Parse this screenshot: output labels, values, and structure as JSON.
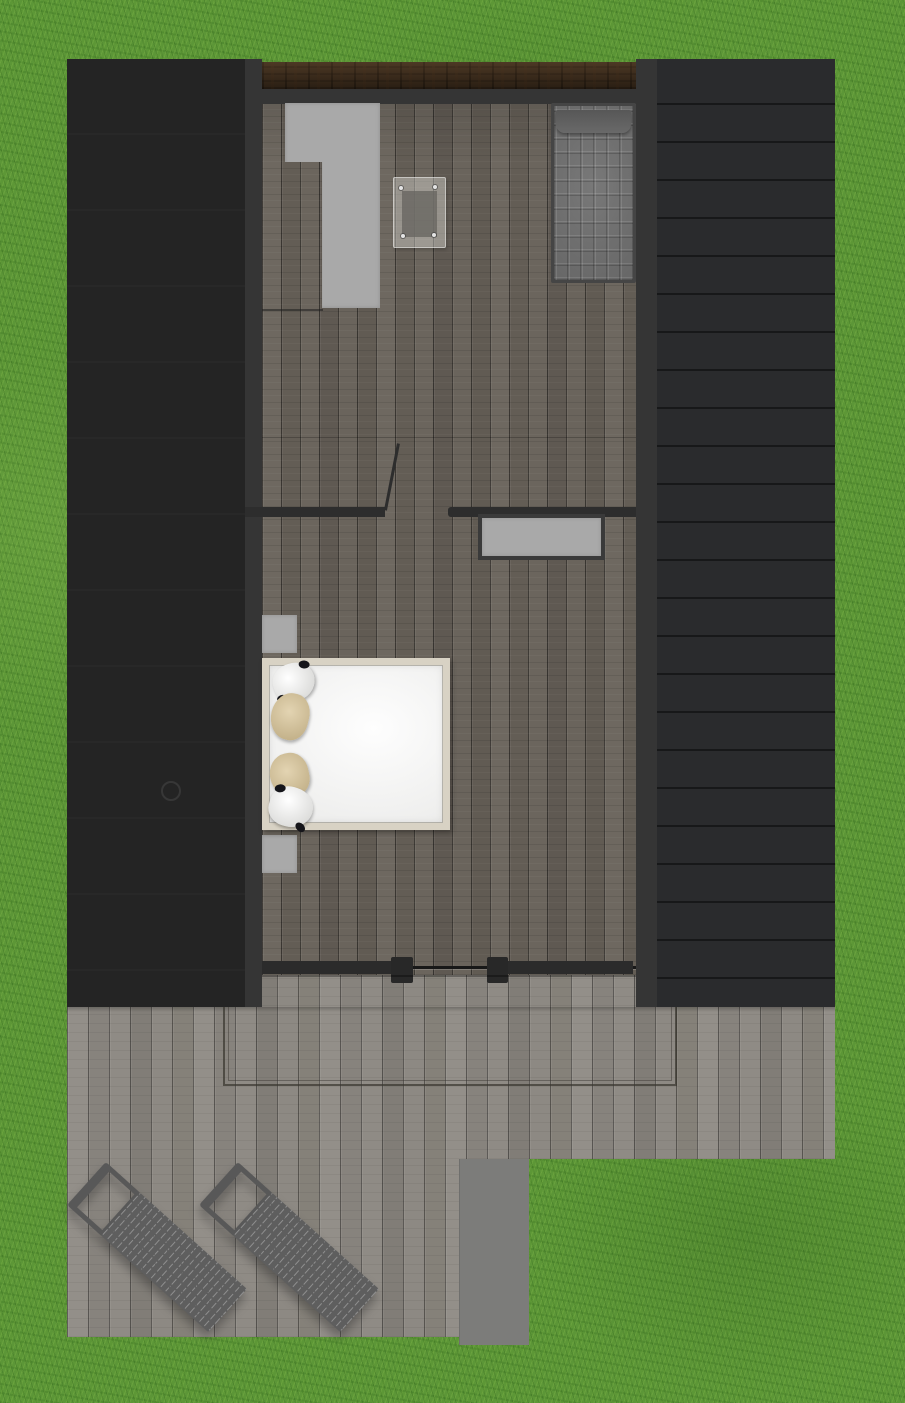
{
  "scene": {
    "type": "floor-plan-top-view-render",
    "canvas": {
      "width": 905,
      "height": 1403
    },
    "description": "Top-down 3D rendered floor plan of a small cabin on a lawn: dark roof panels left and right, wood-plank interior strip in the middle, rear deck with two sun loungers"
  },
  "palette": {
    "grass": "#5c9637",
    "roof_left": "#242424",
    "roof_right": "#2a2b2d",
    "wall": "#353535",
    "beam_brown": "#3c2d1e",
    "floor_wood": "#67615a",
    "deck_wood": "#8b8882",
    "step_gray": "#7c7c7a",
    "furniture_gray": "#a9a9a9",
    "bed_duvet": "#f3f3f2",
    "bed_frame": "#d8d2c4",
    "pillow_tan": "#d3c4a0",
    "pillow_white": "#ededed",
    "mattress_gray": "#6e6e6e",
    "lounger_gray": "#5e5e5e",
    "glass": "#eeeeeb"
  },
  "objects": [
    {
      "name": "lawn",
      "desc": "green grass surrounding the building"
    },
    {
      "name": "roof-panel-left",
      "desc": "dark flat roof panel, faint seams, small round vent"
    },
    {
      "name": "roof-panel-right",
      "desc": "dark flat roof panel with horizontal seam lines"
    },
    {
      "name": "ridge-beam",
      "desc": "dark brown wooden beam across the top of the interior"
    },
    {
      "name": "interior-floor",
      "desc": "vertical dark wood planks"
    },
    {
      "name": "kitchen-counter",
      "desc": "light gray L-shaped counter, top left of interior"
    },
    {
      "name": "glass-table",
      "desc": "translucent glass panel with four fixing screws"
    },
    {
      "name": "single-bed",
      "desc": "quilted gray mattress with pillow, top right of interior",
      "pillow_count": 1
    },
    {
      "name": "partition-wall",
      "desc": "interior wall with door opening and open door leaf"
    },
    {
      "name": "wall-shelf",
      "desc": "light gray dresser below partition wall"
    },
    {
      "name": "nightstand",
      "count": 2,
      "desc": "small light gray squares beside double bed"
    },
    {
      "name": "double-bed",
      "desc": "white duvet, beige frame, four pillows",
      "pillow_count": 4,
      "pillow_colors": [
        "white-dotted",
        "tan",
        "tan",
        "white-dotted"
      ]
    },
    {
      "name": "sliding-glass-door",
      "desc": "glass wall at bottom of interior with two mullion posts",
      "post_count": 2
    },
    {
      "name": "deck",
      "desc": "light gray plank terrace below the house"
    },
    {
      "name": "deck-outline",
      "desc": "thin double-line rectangle marked on deck under the house"
    },
    {
      "name": "deck-step",
      "desc": "plain gray landing strip at bottom of deck"
    },
    {
      "name": "sun-lounger",
      "count": 2,
      "desc": "slatted gray loungers rotated diagonally on the deck"
    }
  ]
}
